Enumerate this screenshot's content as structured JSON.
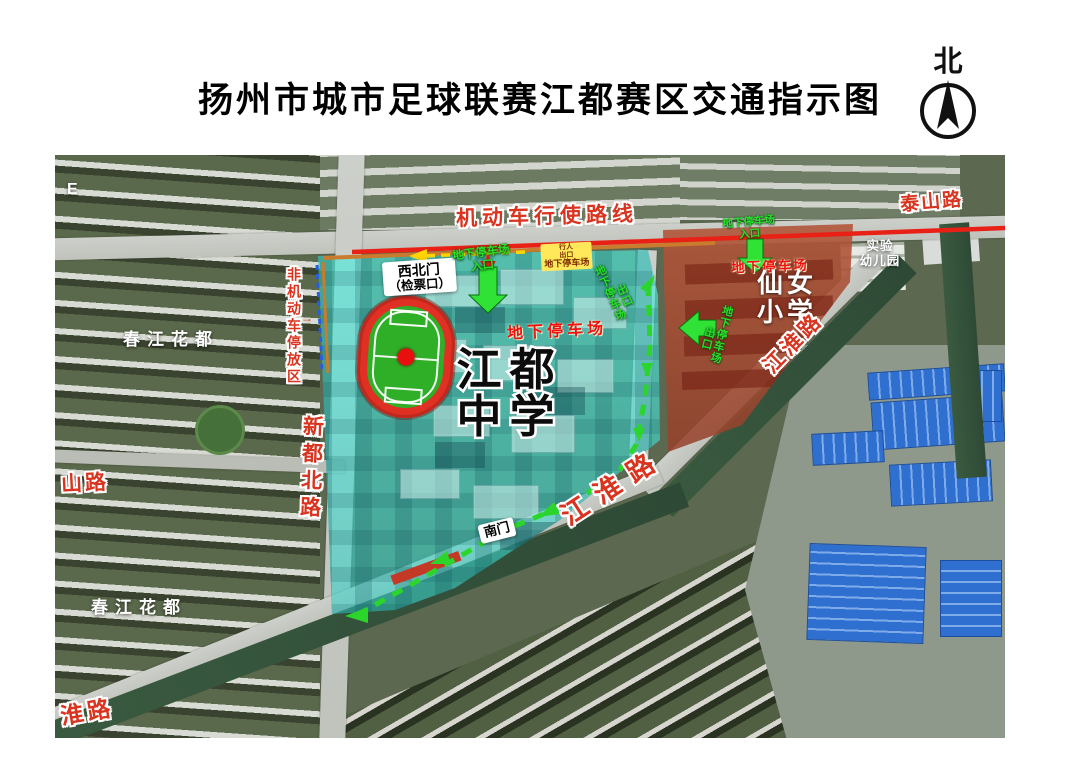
{
  "title": "扬州市城市足球联赛江都赛区交通指示图",
  "compass": {
    "label": "北"
  },
  "routes": {
    "motor_route": "机动车行使路线",
    "nonmotor_area": "非机动车停放区",
    "nonmotor_arrow": "→"
  },
  "roads": {
    "taishan": "泰山路",
    "jianghuai_upper": "江淮路",
    "jianghuai_lower": "江淮路",
    "jianghuai_partial": "淮路",
    "shan_partial": "山路",
    "xindu_north": "新都北路"
  },
  "places": {
    "jiangdu": {
      "line1": "江都",
      "line2": "中学"
    },
    "xiannu": {
      "line1": "仙女",
      "line2": "小学"
    },
    "kindergarten": {
      "line1": "实验",
      "line2": "幼儿园"
    },
    "chunjiang_upper": "春江花都",
    "chunjiang_lower": "春江花都",
    "edge_partial": "E"
  },
  "gates": {
    "northwest_line1": "西北门",
    "northwest_line2": "（检票口）",
    "south": "南门"
  },
  "parking": {
    "underground": "地下停车场",
    "entrance": "入口",
    "exit": "出口",
    "pedestrian_line1": "行人",
    "pedestrian_line2": "出口",
    "pedestrian_line3": "地下停车场"
  },
  "colors": {
    "motor_route_red": "#e82015",
    "walk_route_green": "#2bd52b",
    "dropoff_yellow": "#ffd400",
    "campus_overlay_cyan": "#3fe3d2",
    "school_overlay_red": "#a8503a",
    "nonmotor_dash_blue": "#2b5ce0",
    "road_label_red": "#d9341f"
  }
}
